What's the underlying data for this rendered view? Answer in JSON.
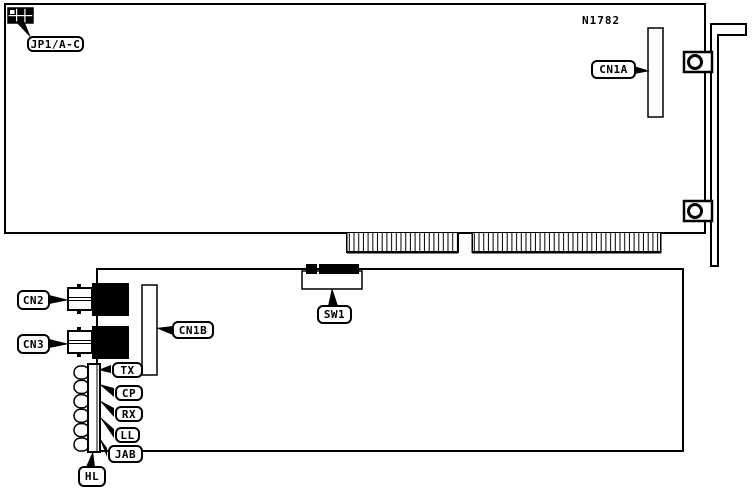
{
  "diagram": {
    "part_number": "N1782",
    "colors": {
      "line": "#000000",
      "background": "#ffffff",
      "component_fill": "#000000"
    },
    "callouts": {
      "jp1": "JP1/A-C",
      "cn1a": "CN1A",
      "cn2": "CN2",
      "cn3": "CN3",
      "cn1b": "CN1B",
      "sw1": "SW1",
      "tx": "TX",
      "cp": "CP",
      "rx": "RX",
      "ll": "LL",
      "jab": "JAB",
      "hl": "HL"
    }
  }
}
